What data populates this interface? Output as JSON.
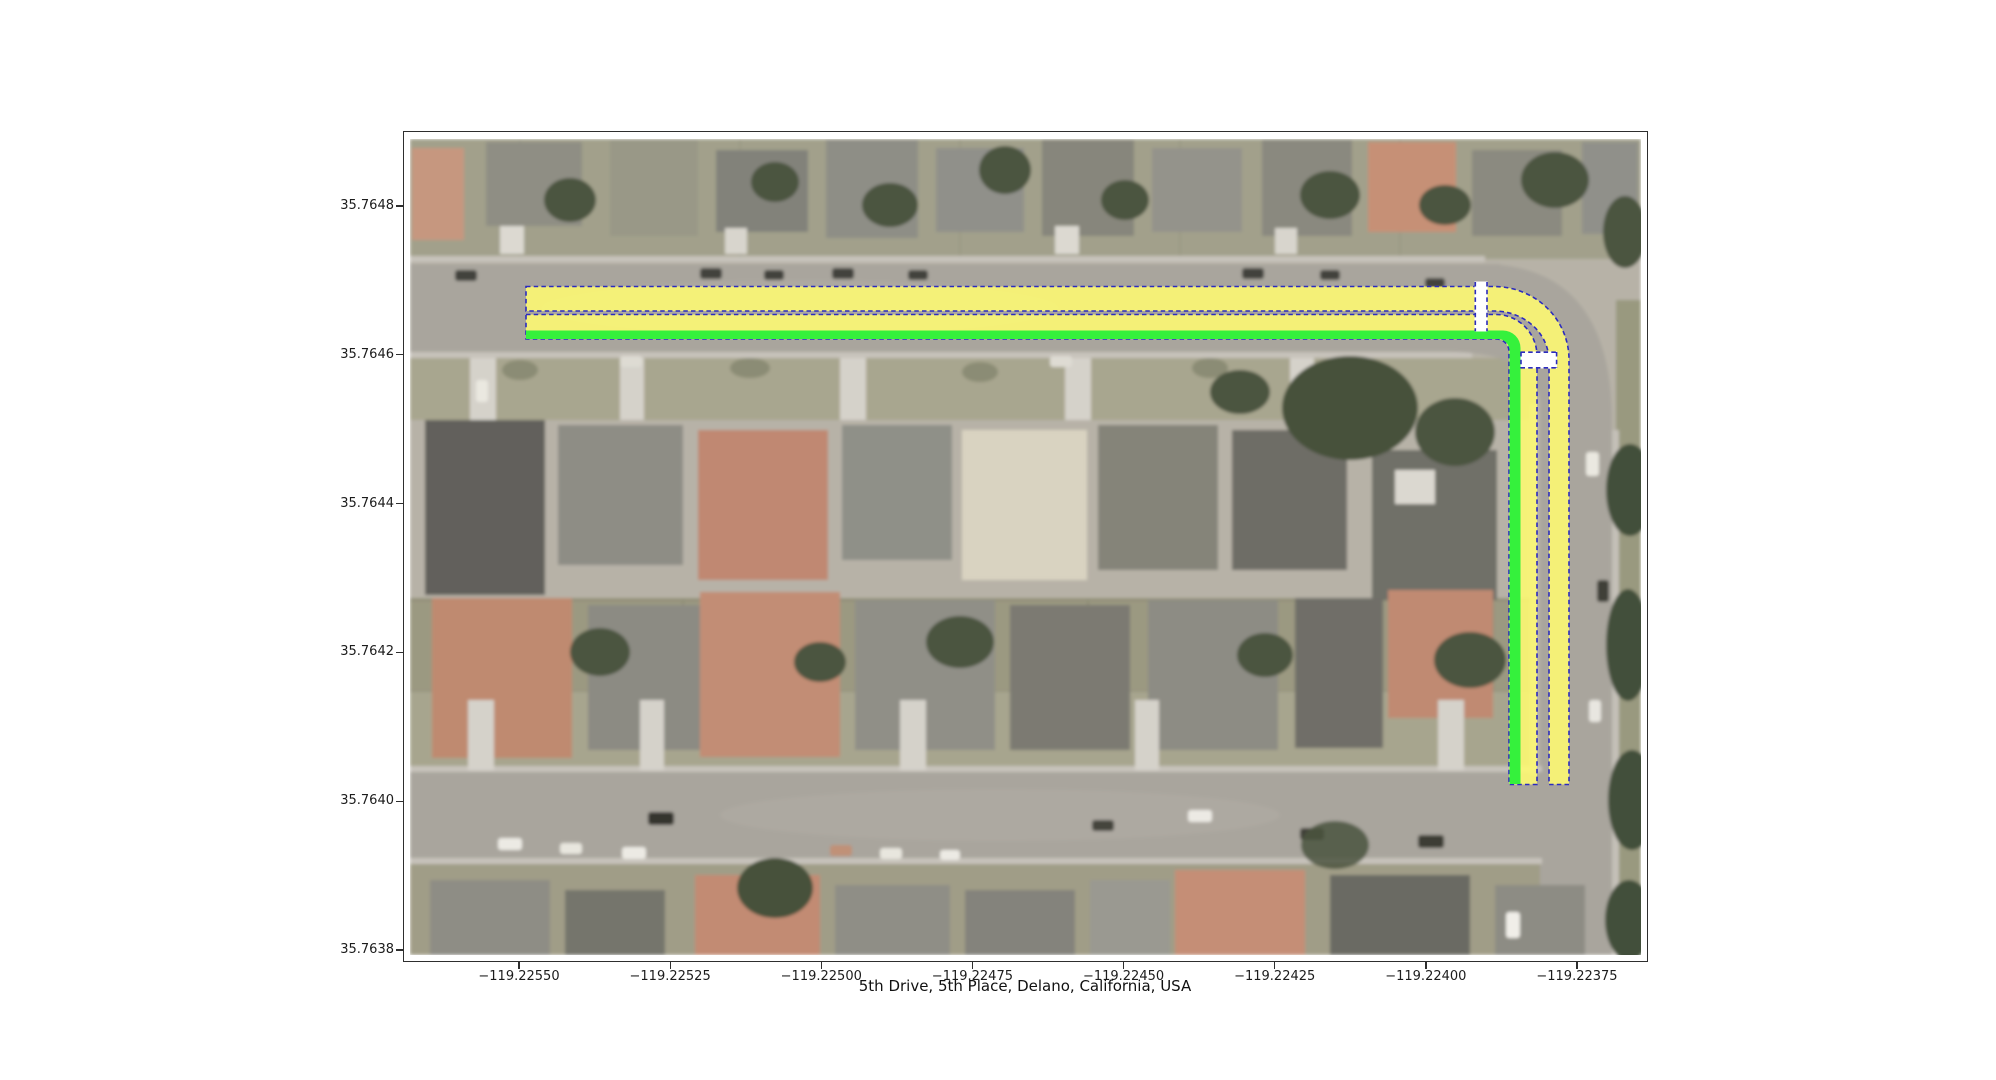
{
  "figure": {
    "xlabel": "5th Drive, 5th Place, Delano, California, USA"
  },
  "axes": {
    "y_ticks": [
      "35.7648",
      "35.7646",
      "35.7644",
      "35.7642",
      "35.7640",
      "35.7638"
    ],
    "x_ticks": [
      "−119.22550",
      "−119.22525",
      "−119.22500",
      "−119.22475",
      "−119.22450",
      "−119.22425",
      "−119.22400",
      "−119.22375"
    ]
  },
  "overlay": {
    "description": "highlighted street route: 5th Drive (horizontal) and 5th Place (vertical) lane bands with crosswalk breaks",
    "colors": {
      "band_yellow": "#FEFB72",
      "band_green": "#35F13C",
      "dash_navy": "#2B2BBF",
      "break_white": "#FFFFFF"
    }
  }
}
